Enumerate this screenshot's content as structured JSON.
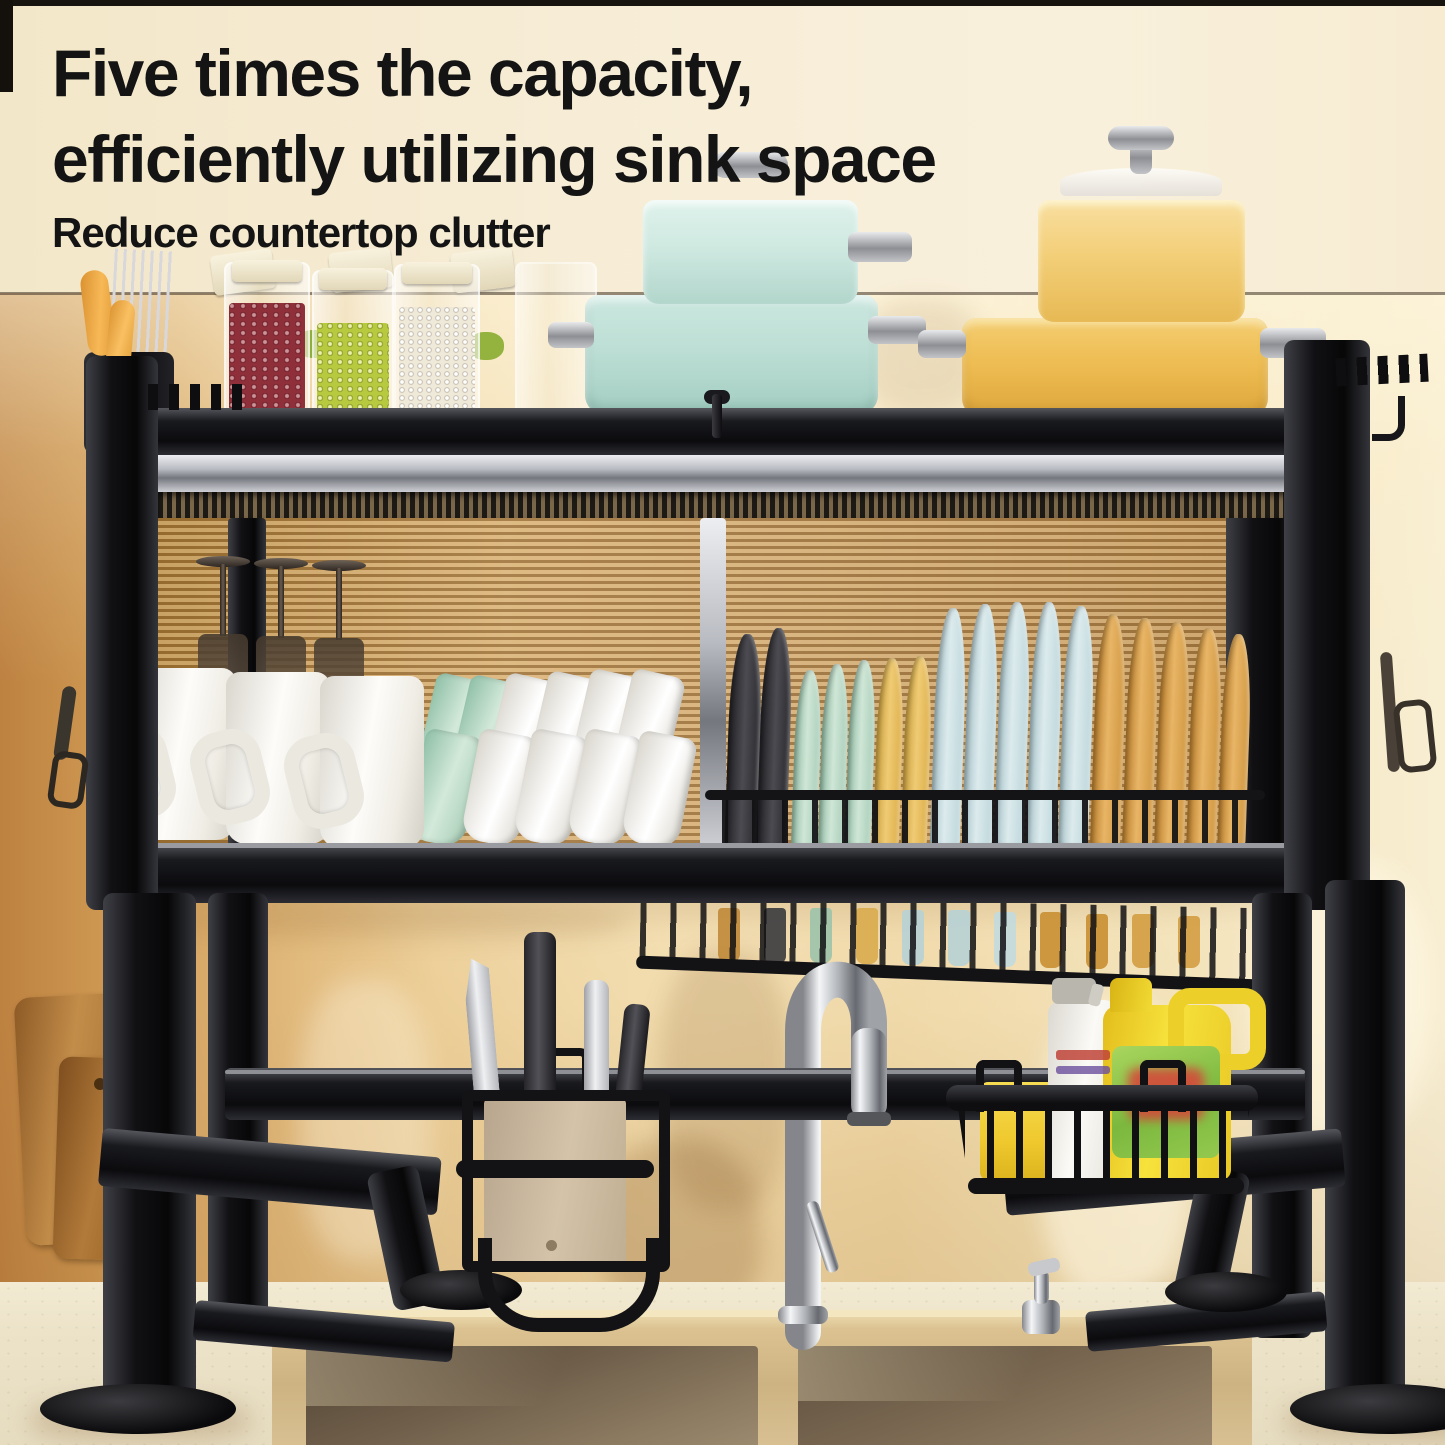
{
  "headline": {
    "line1": "Five times the capacity,",
    "line2": "efficiently utilizing sink space",
    "subtitle": "Reduce countertop clutter"
  },
  "palette": {
    "header_background": "#f6ecd3",
    "headline_text": "#141414",
    "wall_left": "#c8904d",
    "wall_center": "#eed7a6",
    "wall_right": "#f6ead0",
    "rack_black": "#121216",
    "rail_silver": "#b9bbc2",
    "ribbed_glass_amber": "#c99d63",
    "pot_mint_blue": "#cde9e1",
    "pot_yellow": "#f0c767",
    "jar_red_beans": "#8e2f3a",
    "jar_green_beans": "#b7c93e",
    "jar_white_rice": "#efe9da",
    "plate_mint": "#bdd9c6",
    "plate_yellow": "#e9bc55",
    "plate_pale_blue": "#c9dee2",
    "plate_amber": "#d99f47",
    "mug_white": "#f5f3ee",
    "wine_glass_smoke": "#4a4038",
    "cutting_board_wood": "#b67c3e",
    "knife_steel": "#c9c9cd",
    "detergent_yellow": "#f0d42e",
    "detergent_label_green": "#7cb83e",
    "sponge_yellow": "#f2cf3a",
    "spray_bottle_white": "#f3f1ec",
    "faucet_chrome": "#cfd2d6",
    "sink_rim_champagne": "#d9c08e",
    "sink_basin_bronze": "#7b6a54",
    "countertop_cream": "#ece3c9"
  }
}
